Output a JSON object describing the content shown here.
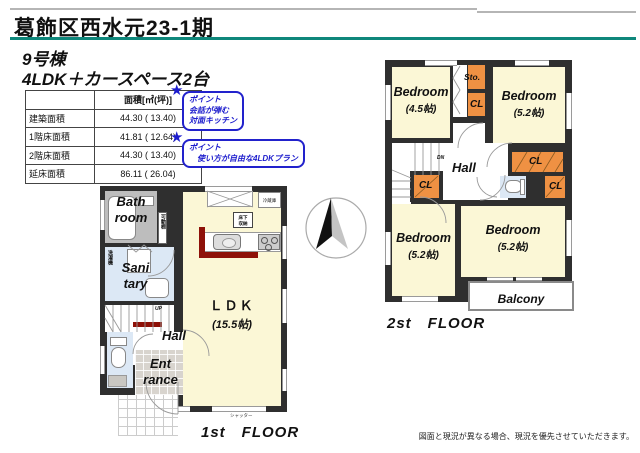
{
  "header": {
    "title": "葛飾区西水元23-1期",
    "building_no": "9号棟",
    "plan_type": "4LDK＋カースペース2台"
  },
  "area_table": {
    "unit_header": "面積[㎡(坪)]",
    "rows": [
      {
        "label": "建築面積",
        "value": "44.30 ( 13.40)"
      },
      {
        "label": "1階床面積",
        "value": "41.81 ( 12.64)"
      },
      {
        "label": "2階床面積",
        "value": "44.30 ( 13.40)"
      },
      {
        "label": "延床面積",
        "value": "86.11 ( 26.04)"
      }
    ]
  },
  "points": [
    {
      "icon": "★",
      "title": "ポイント",
      "lines": [
        "会話が弾む",
        "対面キッチン"
      ]
    },
    {
      "icon": "★",
      "title": "ポイント",
      "lines": [
        "使い方が自由な4LDKプラン"
      ]
    }
  ],
  "floor1": {
    "caption": "1st　FLOOR",
    "bath_1": "Bath",
    "bath_2": "room",
    "sanitary_1": "Sani",
    "sanitary_2": "tary",
    "laundry": "洗濯機",
    "movable_shelf": "可動棚",
    "hall": "Hall",
    "up": "UP",
    "entrance_1": "Ent",
    "entrance_2": "rance",
    "ldk": "ＬＤＫ",
    "ldk_size": "(15.5帖)",
    "refrigerator": "冷蔵庫",
    "underfloor_1": "床下",
    "underfloor_2": "収納",
    "shutter": "シャッター"
  },
  "floor2": {
    "caption": "2st　FLOOR",
    "hall": "Hall",
    "dn": "DN",
    "storage": "Sto.",
    "closet": "CL",
    "balcony": "Balcony",
    "bedrooms": [
      {
        "name": "Bedroom",
        "size": "(4.5帖)"
      },
      {
        "name": "Bedroom",
        "size": "(5.2帖)"
      },
      {
        "name": "Bedroom",
        "size": "(5.2帖)"
      },
      {
        "name": "Bedroom",
        "size": "(5.2帖)"
      }
    ]
  },
  "footer": {
    "disclaimer": "図面と現況が異なる場合、現況を優先させていただきます。"
  },
  "colors": {
    "accent_line": "#0e877b",
    "wall": "#2f2f2f",
    "room_yellow": "#fbf7d6",
    "closet_orange": "#ef9143",
    "bath_gray": "#bdbdbd",
    "water_blue": "#dce8f5",
    "kitchen_counter_red": "#8e1108",
    "point_blue": "#1c1ccd"
  }
}
